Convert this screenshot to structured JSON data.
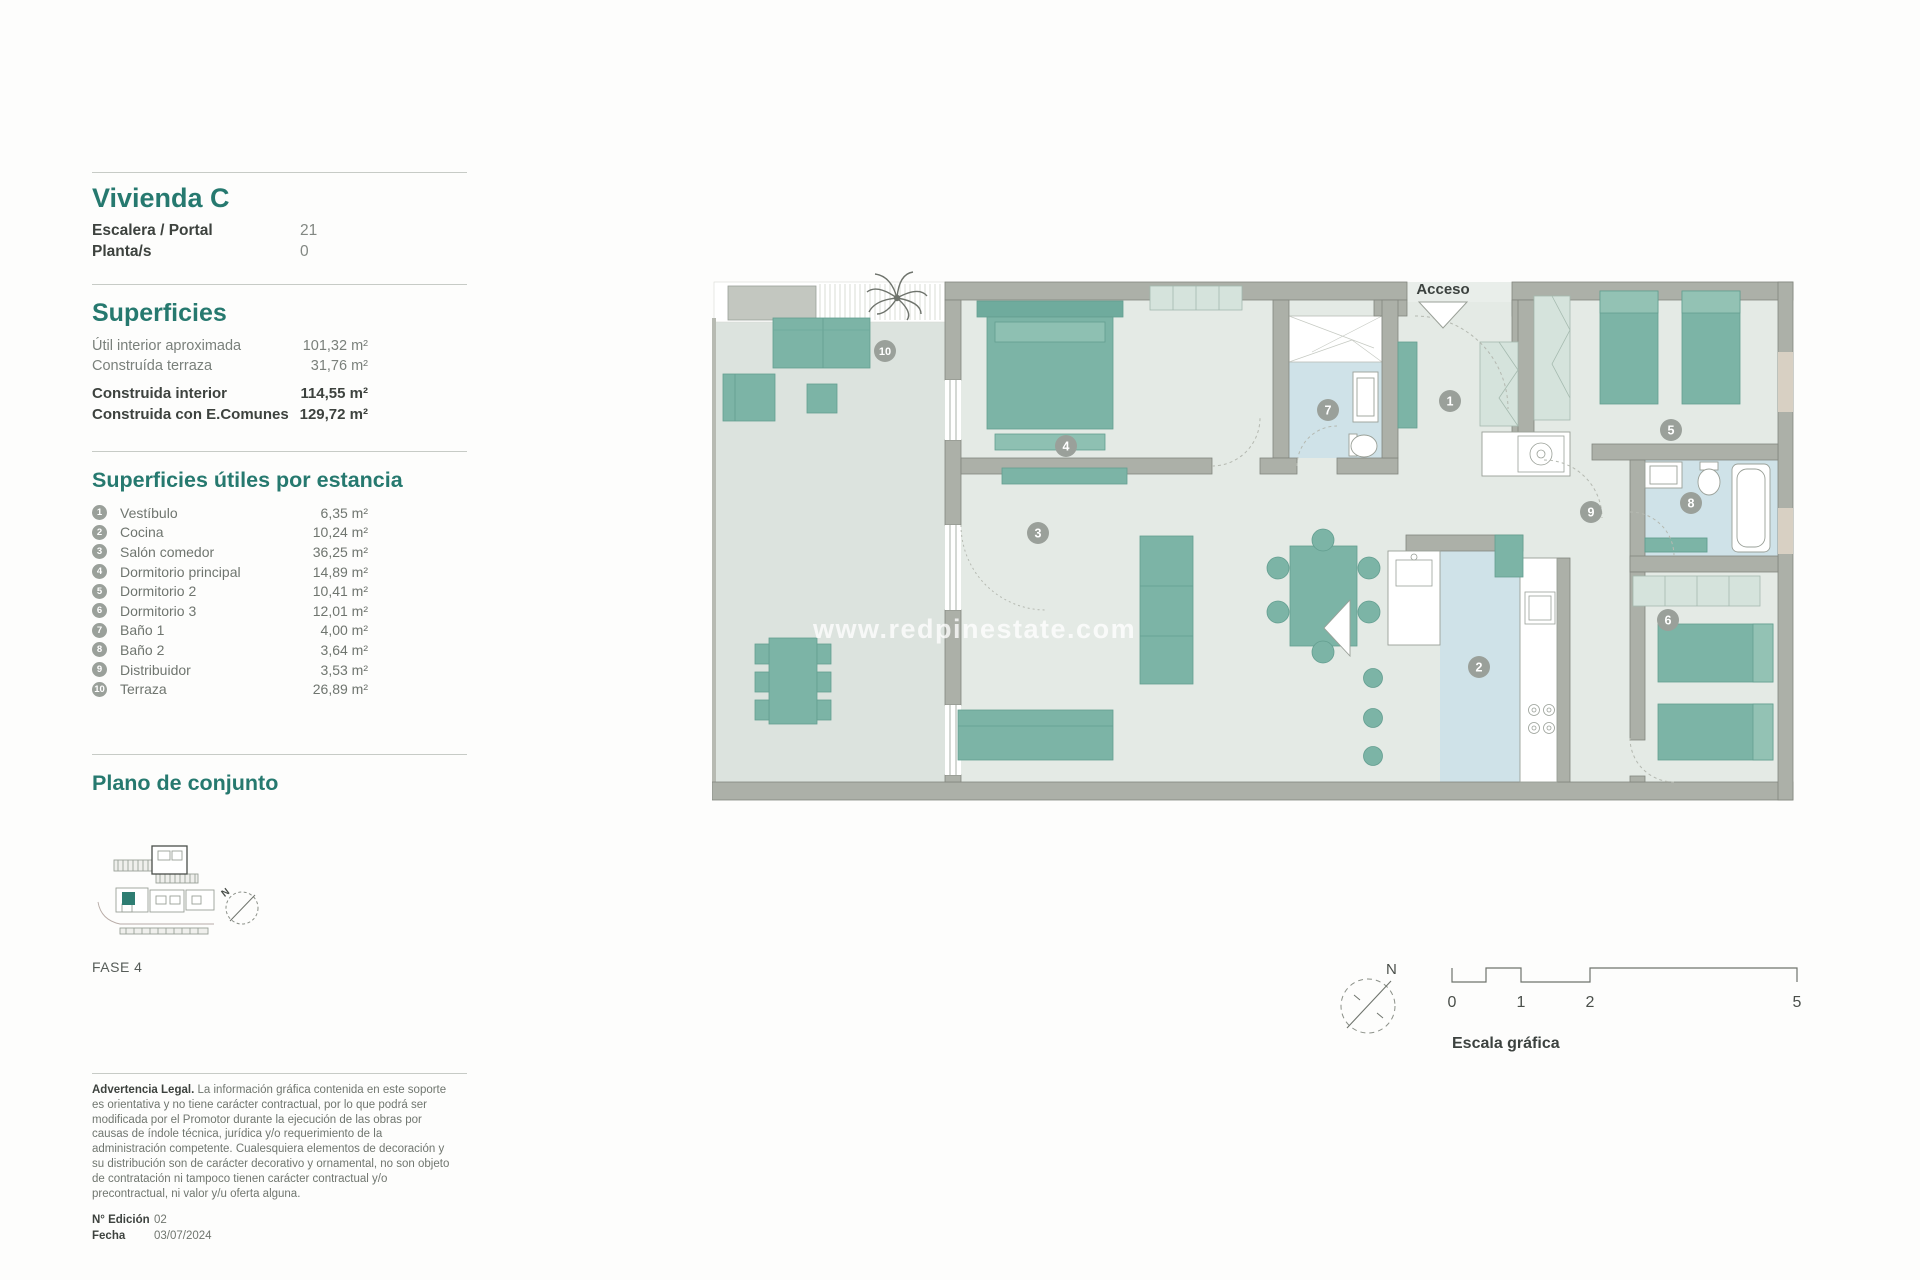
{
  "panel": {
    "title": "Vivienda C",
    "details": [
      {
        "label": "Escalera / Portal",
        "value": "21"
      },
      {
        "label": "Planta/s",
        "value": "0"
      }
    ],
    "superficies": {
      "heading": "Superficies",
      "rows": [
        {
          "label": "Útil interior aproximada",
          "value": "101,32 m²"
        },
        {
          "label": "Construída terraza",
          "value": "31,76 m²"
        },
        {
          "label": "Construida interior",
          "value": "114,55 m²"
        },
        {
          "label": "Construida con E.Comunes",
          "value": "129,72 m²"
        }
      ]
    },
    "estancias": {
      "heading": "Superficies útiles por estancia",
      "rows": [
        {
          "num": "1",
          "label": "Vestíbulo",
          "value": "6,35 m²"
        },
        {
          "num": "2",
          "label": "Cocina",
          "value": "10,24 m²"
        },
        {
          "num": "3",
          "label": "Salón comedor",
          "value": "36,25 m²"
        },
        {
          "num": "4",
          "label": "Dormitorio principal",
          "value": "14,89 m²"
        },
        {
          "num": "5",
          "label": "Dormitorio 2",
          "value": "10,41 m²"
        },
        {
          "num": "6",
          "label": "Dormitorio 3",
          "value": "12,01 m²"
        },
        {
          "num": "7",
          "label": "Baño 1",
          "value": "4,00 m²"
        },
        {
          "num": "8",
          "label": "Baño 2",
          "value": "3,64 m²"
        },
        {
          "num": "9",
          "label": "Distribuidor",
          "value": "3,53 m²"
        },
        {
          "num": "10",
          "label": "Terraza",
          "value": "26,89 m²"
        }
      ]
    },
    "conjunto": {
      "heading": "Plano de conjunto",
      "fase": "FASE 4"
    },
    "legal": {
      "title": "Advertencia Legal.",
      "body": "La información gráfica contenida en este soporte es orientativa y no tiene carácter contractual, por lo que podrá ser modificada por el Promotor durante la ejecución de las obras por causas de índole técnica, jurídica y/o requerimiento de la administración competente. Cualesquiera elementos de decoración y su distribución son de carácter decorativo y ornamental, no son objeto de contratación ni tampoco tienen carácter contractual y/o precontractual, ni valor y/u oferta alguna."
    },
    "edicion": [
      {
        "label": "N° Edición",
        "value": "02"
      },
      {
        "label": "Fecha",
        "value": "03/07/2024"
      }
    ]
  },
  "plan": {
    "acceso": "Acceso",
    "watermark": "www.redpinestate.com",
    "north": "N",
    "numbers": {
      "n1": "1",
      "n2": "2",
      "n3": "3",
      "n4": "4",
      "n5": "5",
      "n6": "6",
      "n7": "7",
      "n8": "8",
      "n9": "9",
      "n10": "10"
    },
    "escala": {
      "label": "Escala gráfica",
      "t0": "0",
      "t1": "1",
      "t2": "2",
      "t5": "5"
    }
  },
  "colors": {
    "teal_heading": "#26796f",
    "furniture_teal": "#7cb4a6",
    "wall_gray": "#acb0a8",
    "floor_green": "#e4eae5",
    "terrace_floor": "#dce3de",
    "wet_floor": "#cfe2e8",
    "badge_gray": "#9aa09a"
  }
}
